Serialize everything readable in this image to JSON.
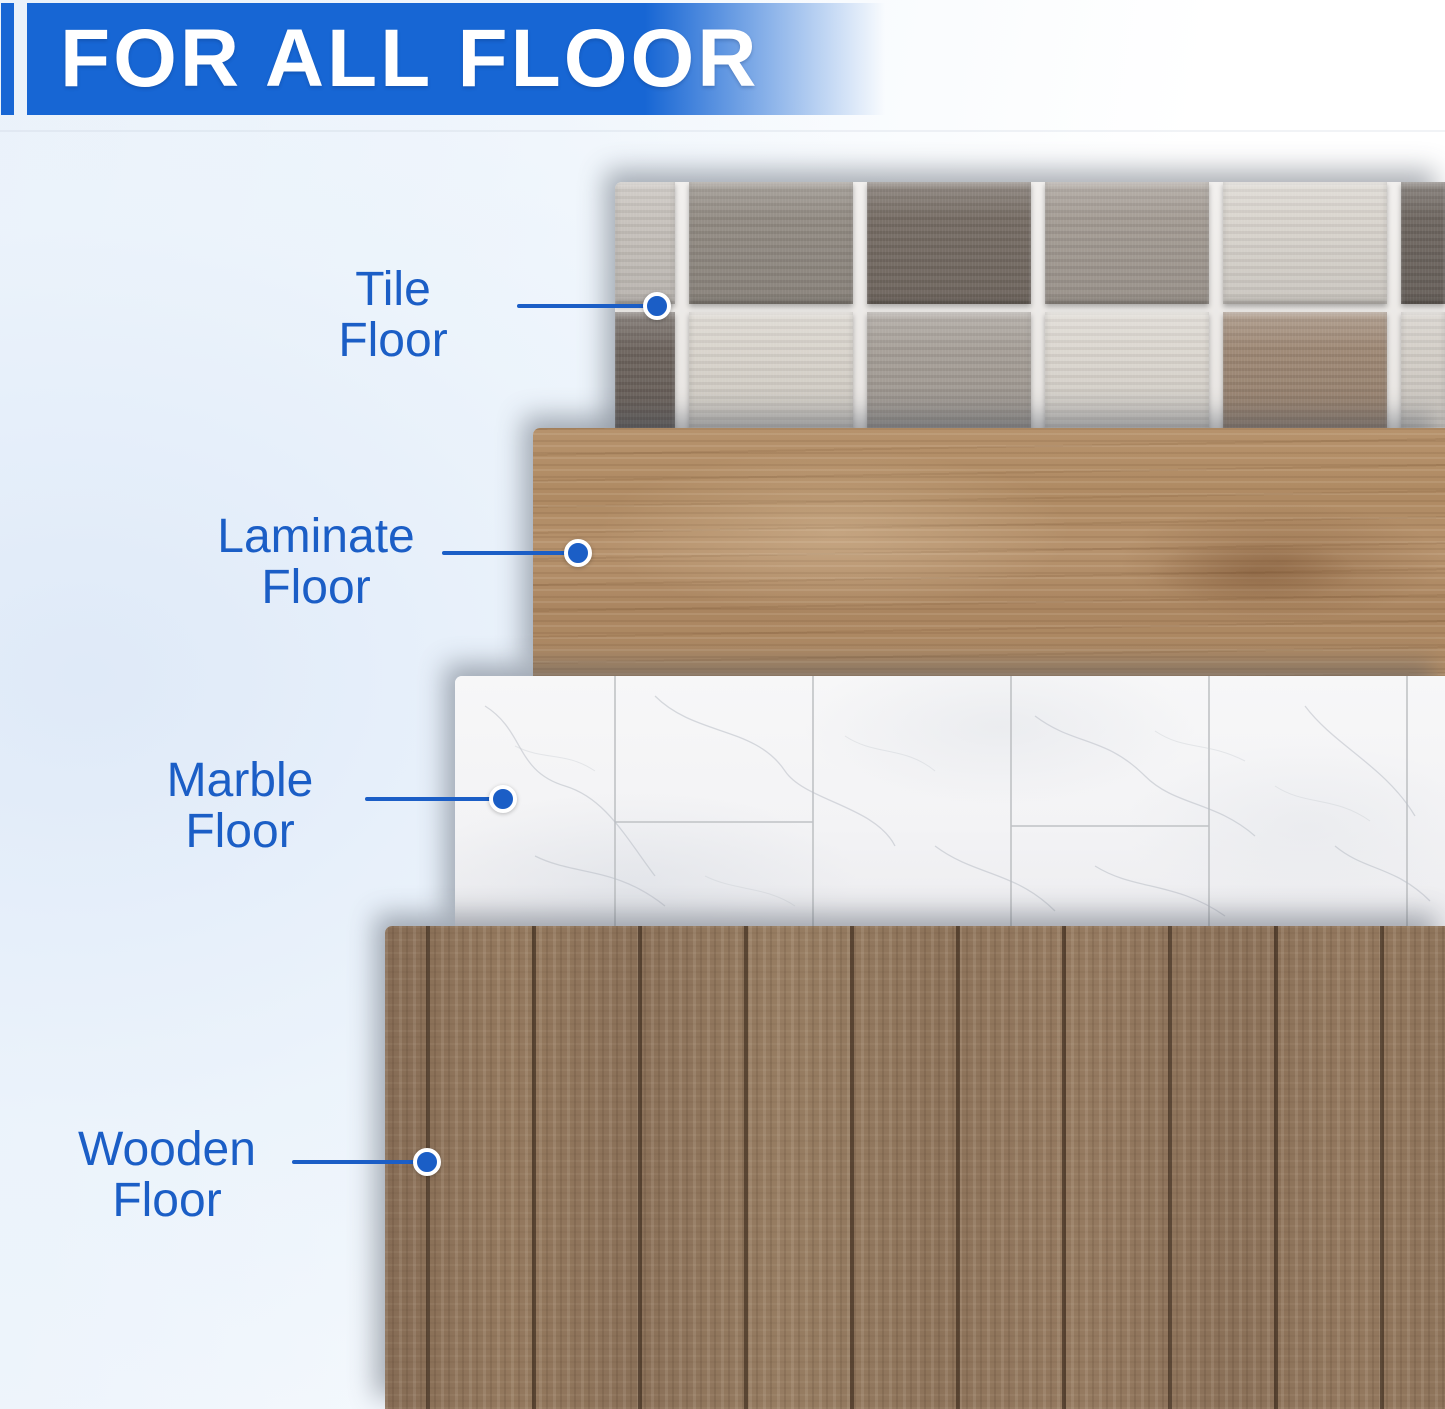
{
  "header": {
    "title": "FOR ALL FLOOR"
  },
  "callouts": [
    {
      "id": "tile-floor",
      "line1": "Tile",
      "line2": "Floor"
    },
    {
      "id": "laminate-floor",
      "line1": "Laminate",
      "line2": "Floor"
    },
    {
      "id": "marble-floor",
      "line1": "Marble",
      "line2": "Floor"
    },
    {
      "id": "wooden-floor",
      "line1": "Wooden",
      "line2": "Floor"
    }
  ],
  "colors": {
    "accent_blue": "#1766d4",
    "label_blue": "#1b5ec6",
    "header_text": "#ffffff",
    "background_tint": "#e4edf8",
    "laminate_wood": "#b2906a",
    "wooden_floor": "#8d735a",
    "marble_white": "#f5f5f6",
    "grout_white": "#efedea"
  },
  "floor_samples": {
    "tile": {
      "shades": [
        [
          "#c6c1bb",
          "#918a82",
          "#756b63",
          "#a29a92",
          "#d9d4cd",
          "#6d655f"
        ],
        [
          "#6b625c",
          "#d8d3cb",
          "#a49d96",
          "#dbd6cf",
          "#9c8673",
          "#d3cec7"
        ]
      ]
    }
  }
}
